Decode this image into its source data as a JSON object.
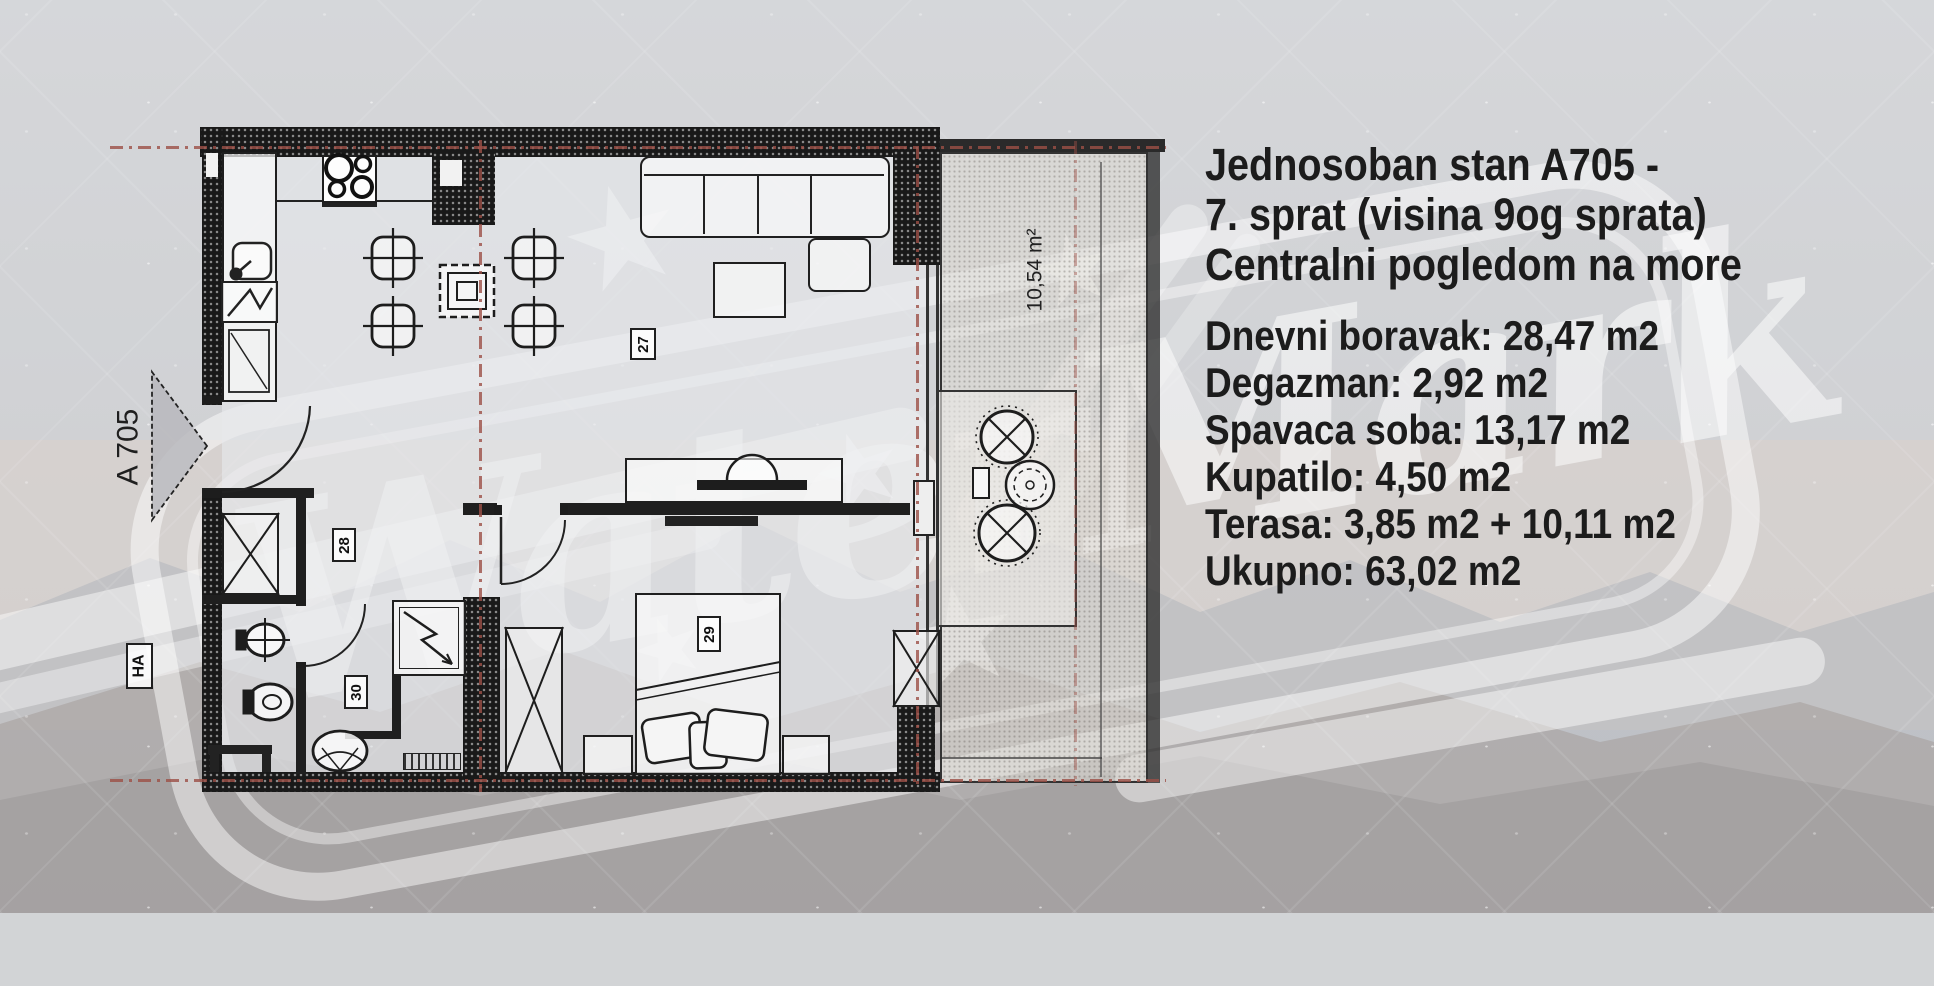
{
  "listing": {
    "title_lines": [
      "Jednosoban stan A705 -",
      "7. sprat (visina 9og sprata)",
      "Centralni pogledom na more"
    ],
    "details_lines": [
      "Dnevni boravak: 28,47 m2",
      "Degazman: 2,92 m2",
      "Spavaca soba: 13,17 m2",
      "Kupatilo: 4,50 m2",
      "Terasa: 3,85 m2 + 10,11 m2",
      "Ukupno: 63,02 m2"
    ]
  },
  "floor_plan": {
    "unit_marker": "A 705",
    "shaft_label": "HA",
    "terrace_area_label": "10,54 m²",
    "room_numbers": {
      "living_room": "27",
      "hallway": "28",
      "bedroom": "29",
      "bathroom": "30"
    }
  },
  "watermark": {
    "text": "WaterMark",
    "star_glyph": "★"
  },
  "colors": {
    "reference_line": "#9c4f46",
    "wall": "#1b1b1b",
    "text": "#1c1c1c",
    "watermark": "rgba(255,255,255,0.5)"
  }
}
